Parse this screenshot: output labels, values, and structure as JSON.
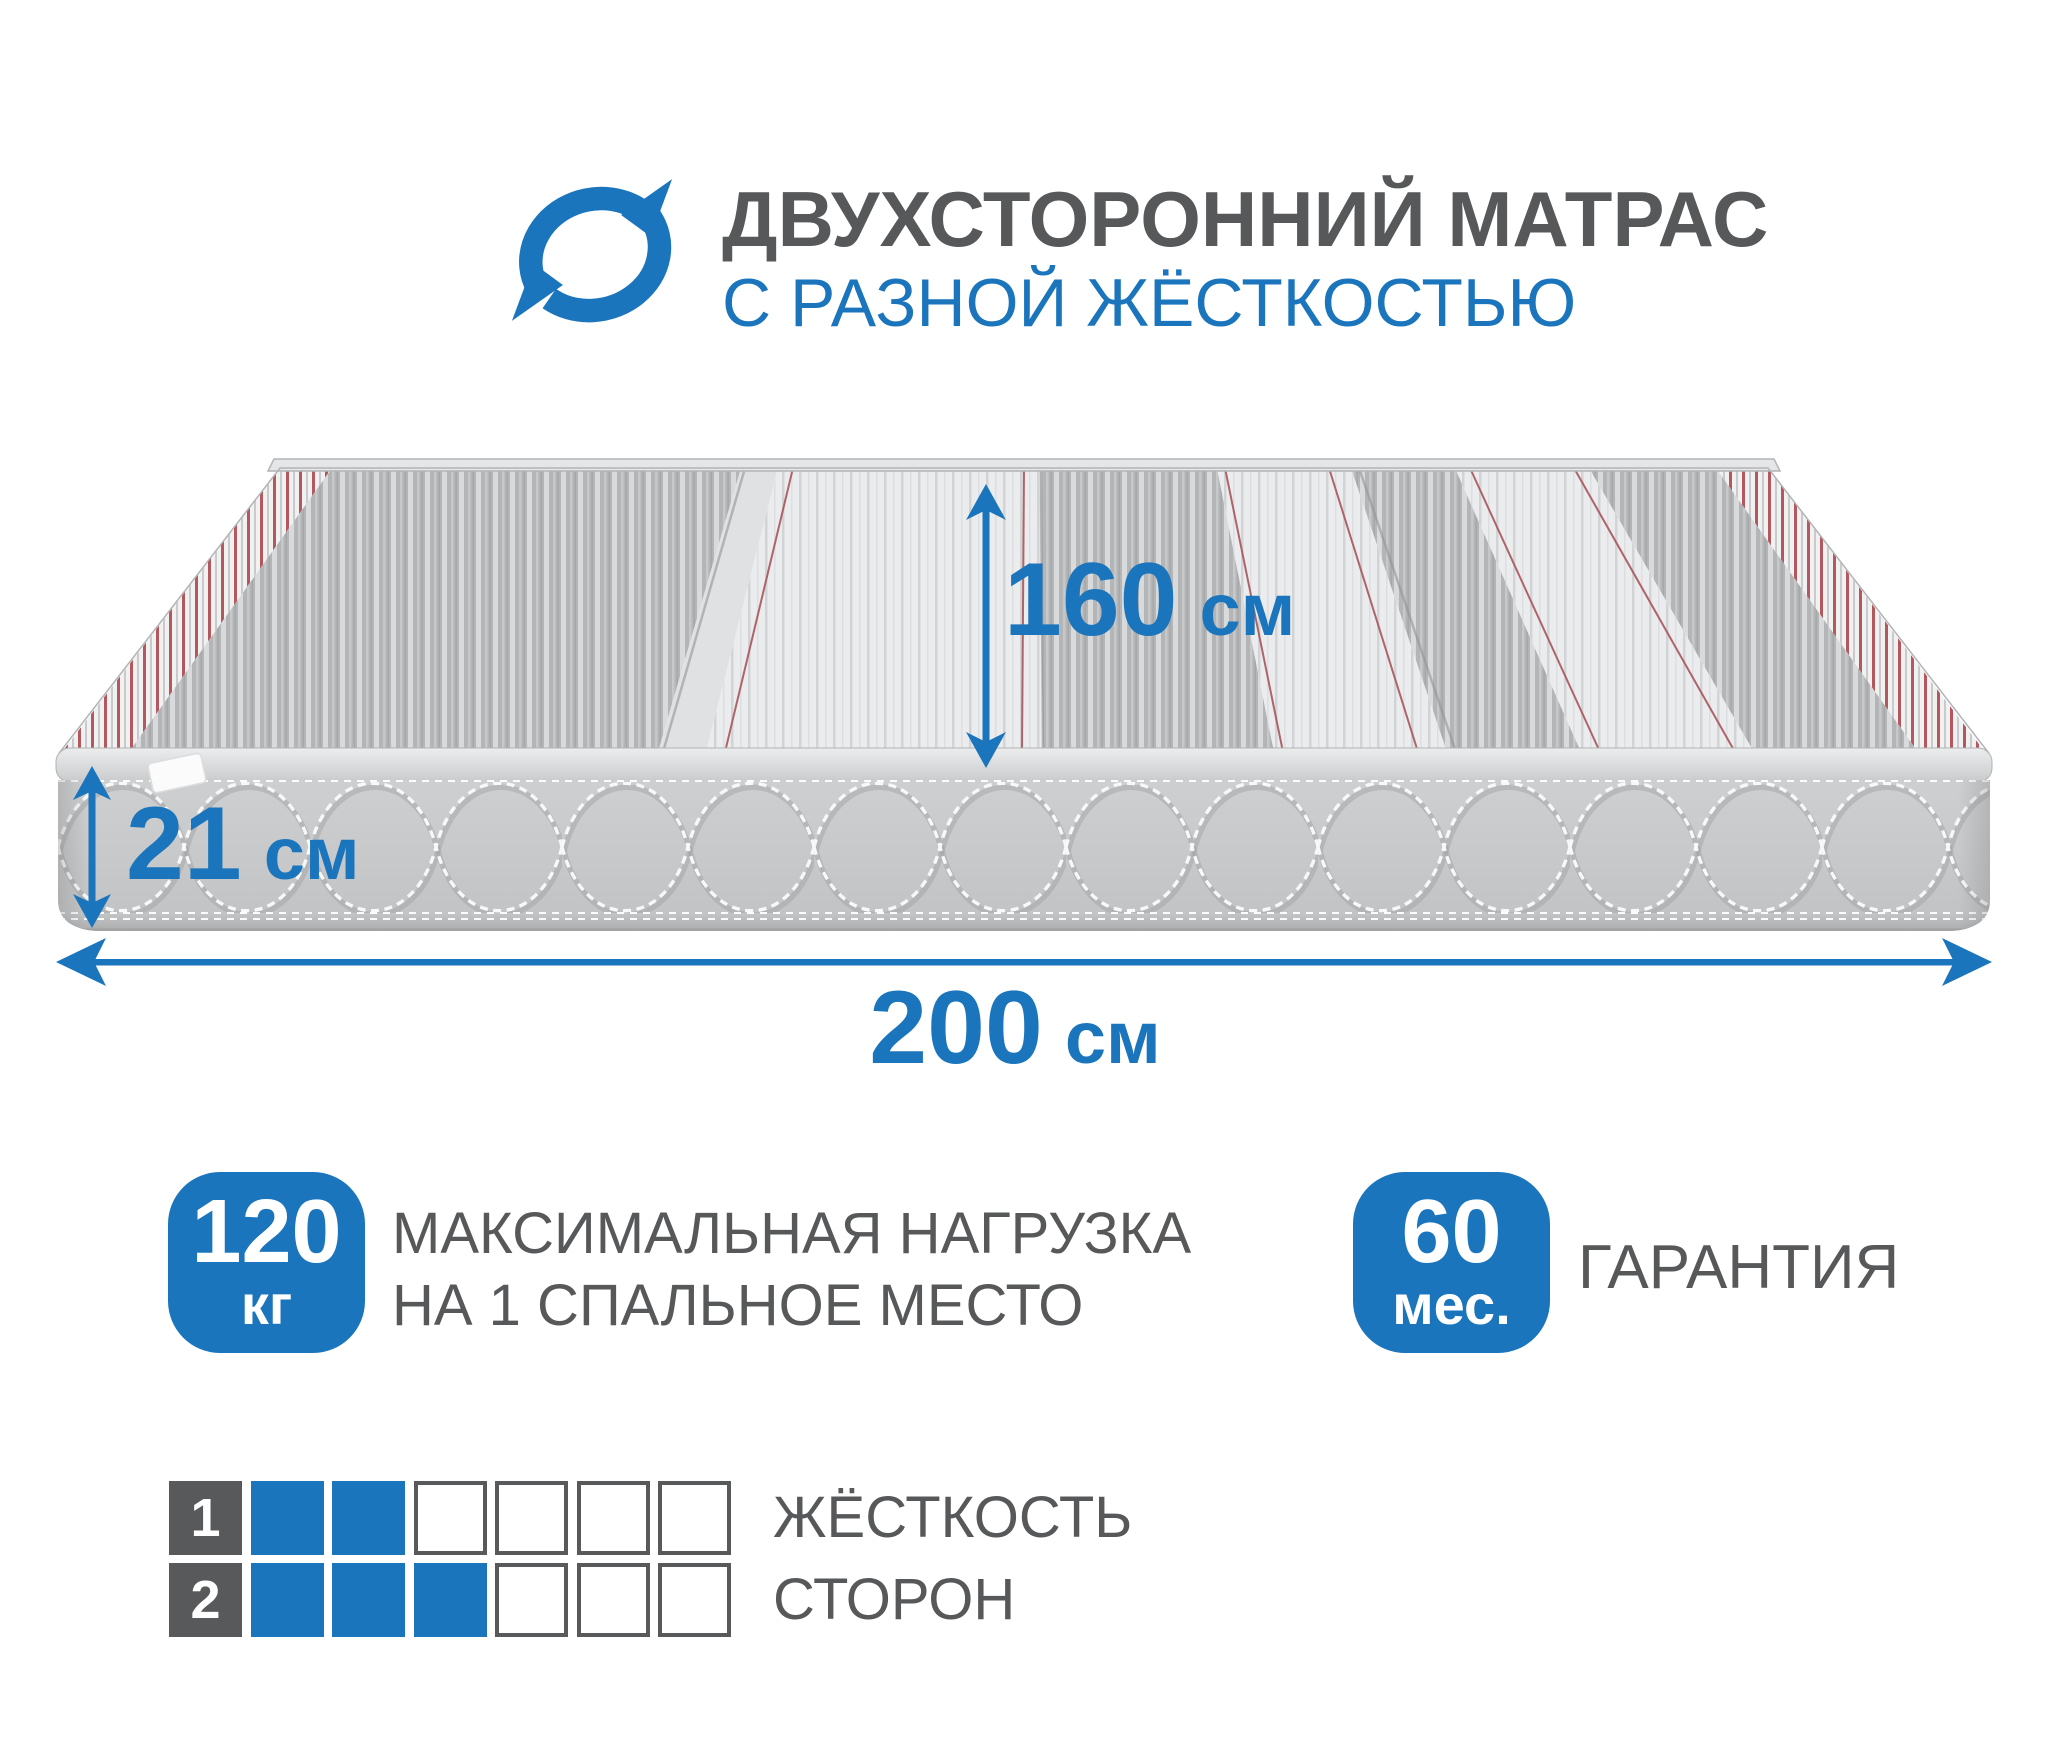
{
  "colors": {
    "accent_blue": "#1b75bc",
    "text_gray": "#57585a",
    "square_gray": "#58595b"
  },
  "header": {
    "icon": "rotate-arrows",
    "title": "ДВУХСТОРОННИЙ МАТРАС",
    "subtitle": "С РАЗНОЙ ЖЁСТКОСТЬЮ"
  },
  "diagram": {
    "depth": {
      "value": "160",
      "unit": "см"
    },
    "height": {
      "value": "21",
      "unit": "см"
    },
    "width": {
      "value": "200",
      "unit": "см"
    }
  },
  "features": {
    "max_load": {
      "badge_value": "120",
      "badge_unit": "кг",
      "label_line1": "МАКСИМАЛЬНАЯ НАГРУЗКА",
      "label_line2": "НА 1 СПАЛЬНОЕ МЕСТО"
    },
    "warranty": {
      "badge_value": "60",
      "badge_unit": "мес.",
      "label": "ГАРАНТИЯ"
    }
  },
  "firmness_scale": {
    "label_line1": "ЖЁСТКОСТЬ",
    "label_line2": "СТОРОН",
    "cells_total": 6,
    "rows": [
      {
        "index": "1",
        "filled": 2
      },
      {
        "index": "2",
        "filled": 3
      }
    ]
  }
}
